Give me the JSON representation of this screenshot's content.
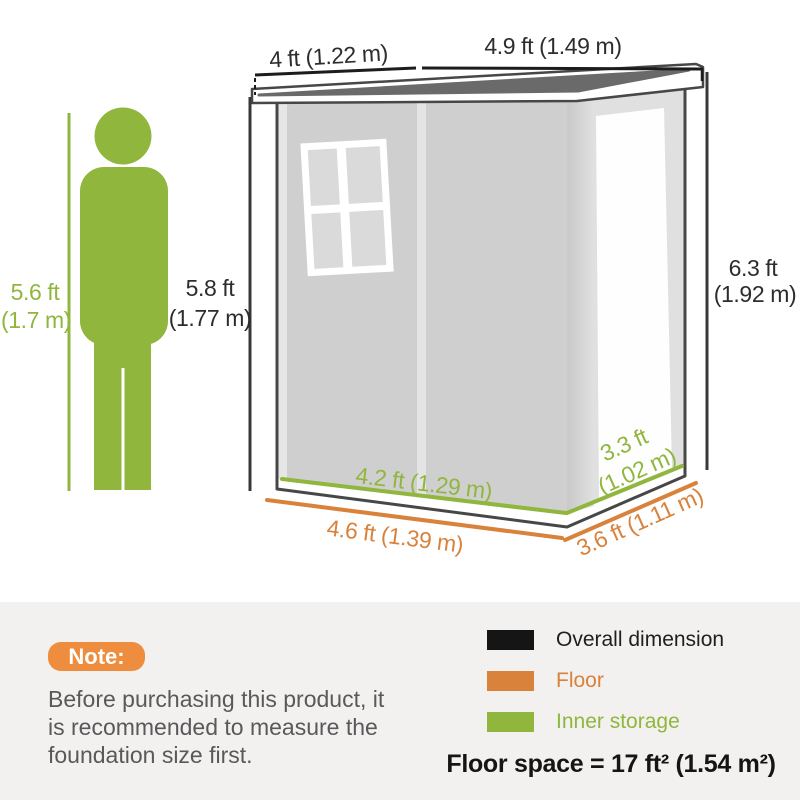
{
  "dimensions": {
    "person_height_l1": "5.6 ft",
    "person_height_l2": "(1.7 m)",
    "front_height_l1": "5.8 ft",
    "front_height_l2": "(1.77 m)",
    "rear_height_l1": "6.3 ft",
    "rear_height_l2": "(1.92 m)",
    "roof_left": "4 ft (1.22 m)",
    "roof_right": "4.9 ft (1.49 m)",
    "inner_front": "4.2 ft (1.29 m)",
    "inner_side_l1": "3.3 ft",
    "inner_side_l2": "(1.02 m)",
    "floor_front": "4.6 ft (1.39 m)",
    "floor_side": "3.6 ft (1.11 m)"
  },
  "note": {
    "badge": "Note:",
    "lines": [
      "Before purchasing this product, it",
      "is recommended to measure the",
      "foundation size first."
    ]
  },
  "legend": {
    "items": [
      {
        "label": "Overall dimension",
        "color": "#151515"
      },
      {
        "label": "Floor",
        "color": "#d9823b"
      },
      {
        "label": "Inner storage",
        "color": "#90b63e"
      }
    ],
    "floor_space": "Floor space = 17 ft² (1.54 m²)"
  },
  "colors": {
    "inner_storage_green": "#90b63e",
    "floor_orange": "#d9823b",
    "overall_black": "#151515",
    "note_badge_orange": "#ee8d3d",
    "roof_gray": "#6a6a6a",
    "wall_gray": "#cfcfcf",
    "panel_background": "#f2f1ef"
  }
}
